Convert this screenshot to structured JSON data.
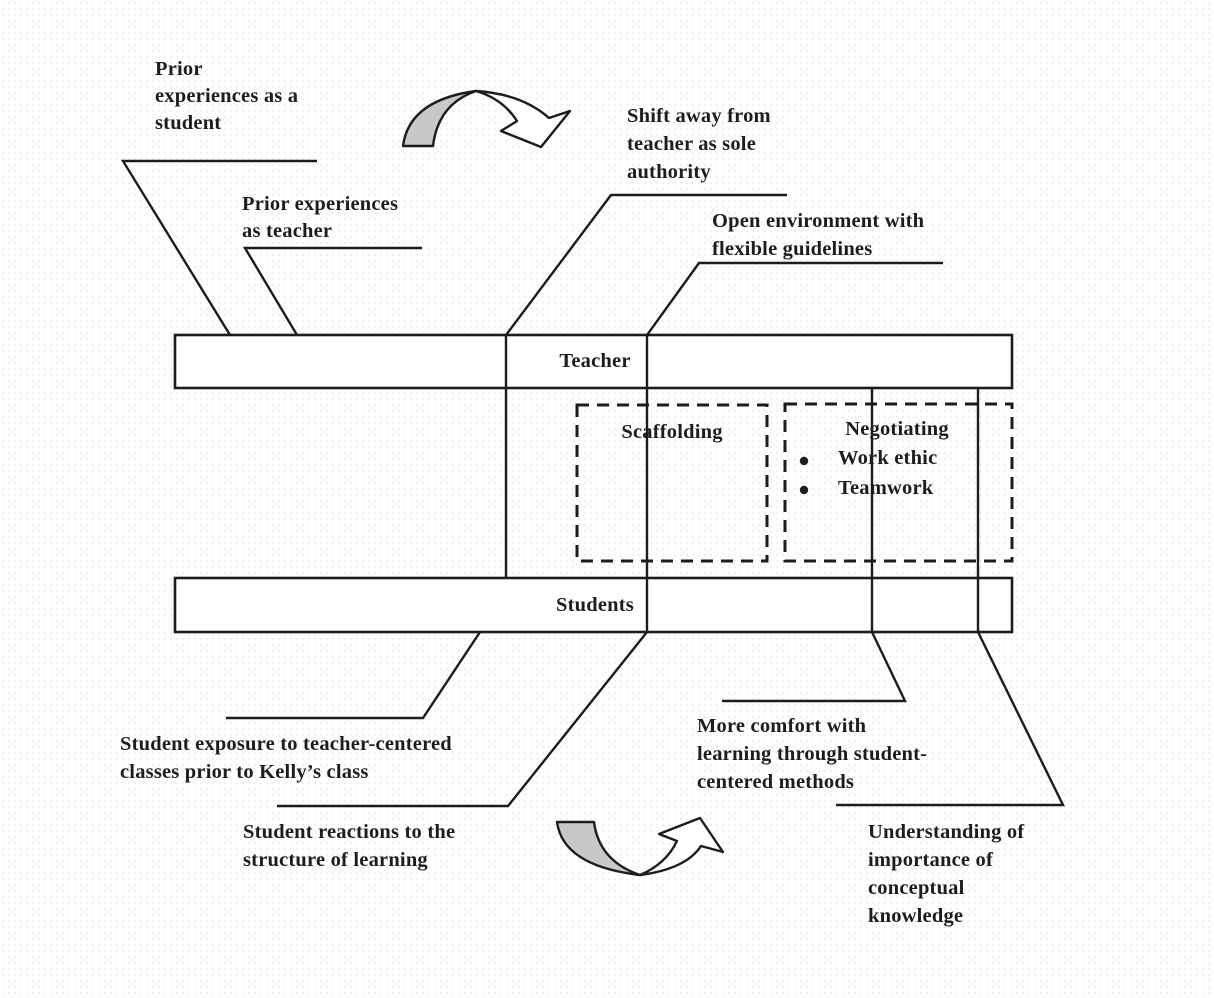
{
  "figure": {
    "bars": {
      "teacher_label": "Teacher",
      "students_label": "Students"
    },
    "boxes": {
      "scaffolding_label": "Scaffolding",
      "negotiating_label": "Negotiating",
      "negotiating_bullets": [
        "Work ethic",
        "Teamwork"
      ]
    },
    "annotations": {
      "prior_student": [
        "Prior",
        "experiences as a",
        "student"
      ],
      "prior_teacher": [
        "Prior experiences",
        "as teacher"
      ],
      "shift_away": [
        "Shift away from",
        "teacher as sole",
        "authority"
      ],
      "open_environment": [
        "Open environment with",
        "flexible guidelines"
      ],
      "student_exposure": [
        "Student exposure to teacher-centered",
        "classes prior to Kelly’s class"
      ],
      "student_reactions": [
        "Student reactions to the",
        "structure of learning"
      ],
      "more_comfort": [
        "More comfort with",
        "learning through student-",
        "centered methods"
      ],
      "understanding": [
        "Understanding of",
        "importance of",
        "conceptual",
        "knowledge"
      ]
    },
    "icons": {
      "top_arrow": "curved-arrow-down-right",
      "bottom_arrow": "curved-arrow-up-right"
    },
    "colors": {
      "line": "#1c1c1c",
      "arrow_fill": "#c8c8c6",
      "background": "#fefefe"
    }
  }
}
